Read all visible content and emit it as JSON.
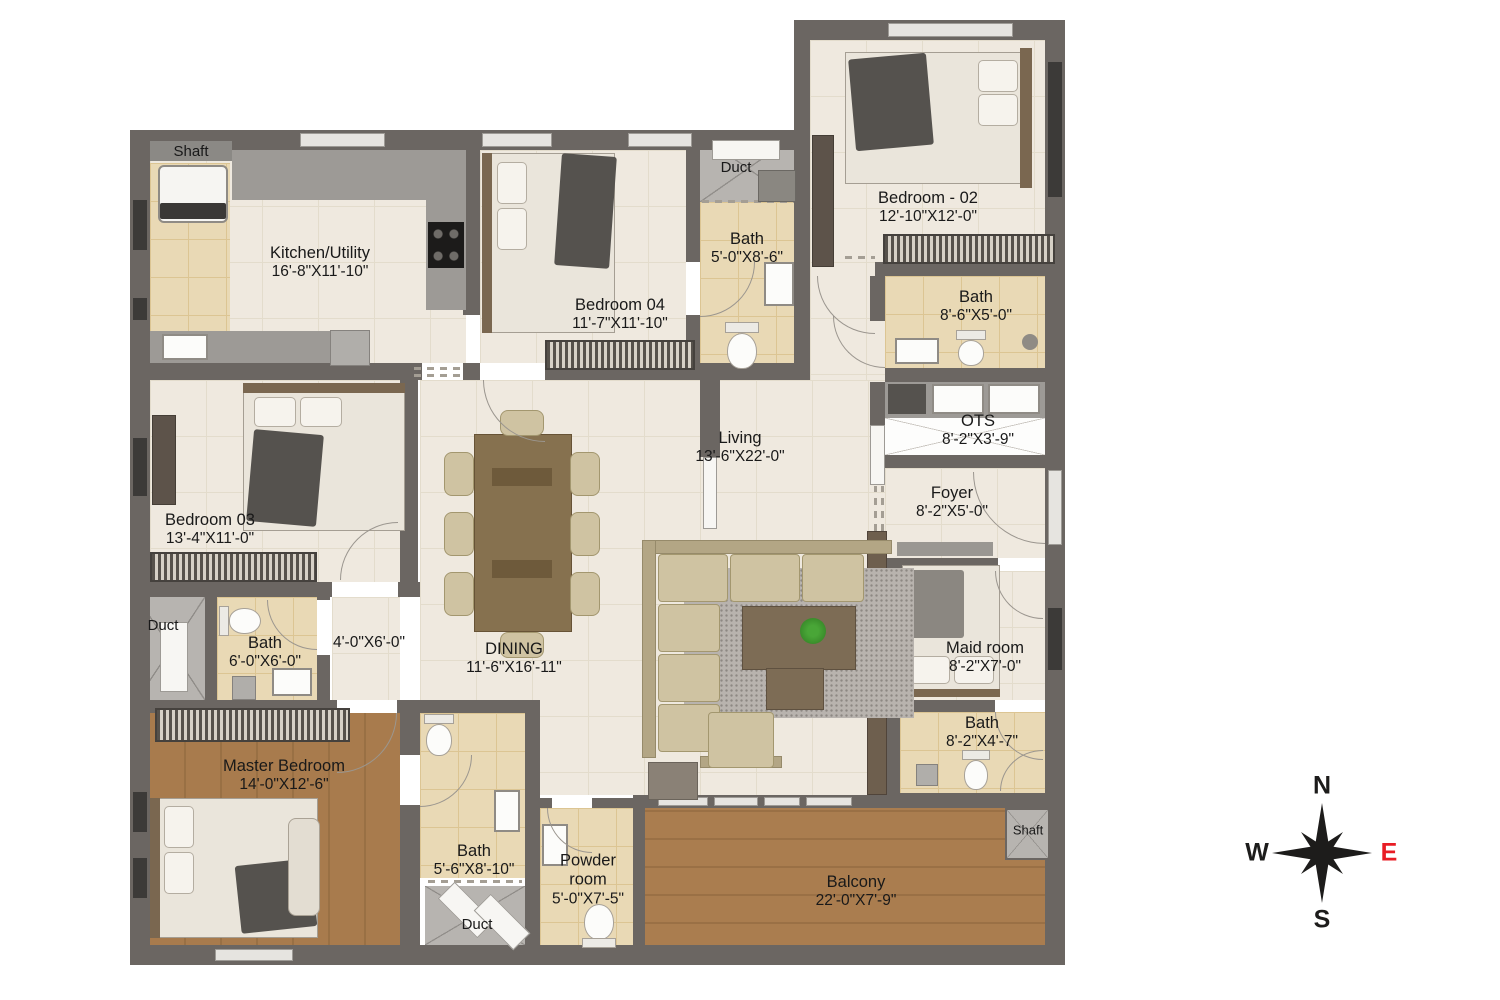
{
  "plan_title": "Apartment Floor Plan",
  "rooms": [
    {
      "id": "shaft-top-left",
      "name": "Shaft",
      "dims": ""
    },
    {
      "id": "kitchen",
      "name": "Kitchen/Utility",
      "dims": "16'-8\"X11'-10\""
    },
    {
      "id": "bedroom-04",
      "name": "Bedroom 04",
      "dims": "11'-7\"X11'-10\""
    },
    {
      "id": "duct-top",
      "name": "Duct",
      "dims": ""
    },
    {
      "id": "bath-top",
      "name": "Bath",
      "dims": "5'-0\"X8'-6\""
    },
    {
      "id": "bedroom-02",
      "name": "Bedroom - 02",
      "dims": "12'-10\"X12'-0\""
    },
    {
      "id": "bath-right",
      "name": "Bath",
      "dims": "8'-6\"X5'-0\""
    },
    {
      "id": "ots",
      "name": "OTS",
      "dims": "8'-2\"X3'-9\""
    },
    {
      "id": "living",
      "name": "Living",
      "dims": "13'-6\"X22'-0\""
    },
    {
      "id": "foyer",
      "name": "Foyer",
      "dims": "8'-2\"X5'-0\""
    },
    {
      "id": "bedroom-03",
      "name": "Bedroom 03",
      "dims": "13'-4\"X11'-0\""
    },
    {
      "id": "duct-left",
      "name": "Duct",
      "dims": ""
    },
    {
      "id": "bath-6x6",
      "name": "Bath",
      "dims": "6'-0\"X6'-0\""
    },
    {
      "id": "passage",
      "name": "",
      "dims": "4'-0\"X6'-0\""
    },
    {
      "id": "dining",
      "name": "DINING",
      "dims": "11'-6\"X16'-11\""
    },
    {
      "id": "maid-room",
      "name": "Maid room",
      "dims": "8'-2\"X7'-0\""
    },
    {
      "id": "bath-maid",
      "name": "Bath",
      "dims": "8'-2\"X4'-7\""
    },
    {
      "id": "master-bedroom",
      "name": "Master Bedroom",
      "dims": "14'-0\"X12'-6\""
    },
    {
      "id": "bath-master",
      "name": "Bath",
      "dims": "5'-6\"X8'-10\""
    },
    {
      "id": "powder-room",
      "name": "Powder room",
      "dims": "5'-0\"X7'-5\""
    },
    {
      "id": "duct-bottom",
      "name": "Duct",
      "dims": ""
    },
    {
      "id": "balcony",
      "name": "Balcony",
      "dims": "22'-0\"X7'-9\""
    },
    {
      "id": "shaft-balcony",
      "name": "Shaft",
      "dims": ""
    }
  ],
  "compass": {
    "north": "N",
    "south": "S",
    "east": "E",
    "west": "W"
  },
  "colors": {
    "wall": "#6b6662",
    "floor_tile": "#efe9df",
    "bath_tile": "#e9d9b5",
    "wood": "#a5784a",
    "counter": "#9d9a96",
    "compass_east": "#e81c24",
    "label_text": "#191919"
  }
}
